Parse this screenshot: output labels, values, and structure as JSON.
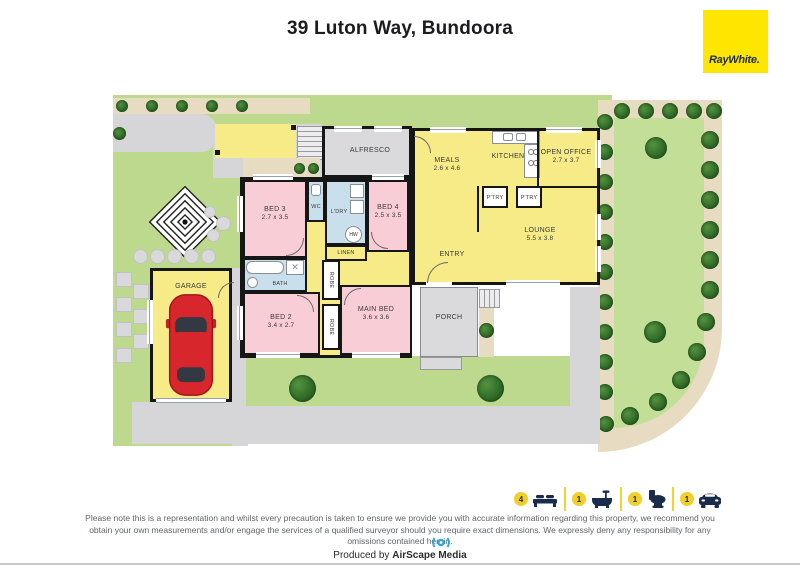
{
  "title": "39 Luton Way, Bundoora",
  "brand": {
    "logo_text": "RayWhite.",
    "bg_color": "#FFE600",
    "text_color": "#1D2B4F"
  },
  "floorplan": {
    "rooms": {
      "alfresco": {
        "name": "ALFRESCO"
      },
      "meals": {
        "name": "MEALS",
        "dims": "2.6 x 4.6"
      },
      "kitchen": {
        "name": "KITCHEN"
      },
      "open_office": {
        "name": "OPEN OFFICE",
        "dims": "2.7 x 3.7"
      },
      "pantry1": {
        "name": "P'TRY"
      },
      "pantry2": {
        "name": "P'TRY"
      },
      "lounge": {
        "name": "LOUNGE",
        "dims": "5.5 x 3.8"
      },
      "entry": {
        "name": "ENTRY"
      },
      "bed3": {
        "name": "BED 3",
        "dims": "2.7 x 3.5"
      },
      "bed4": {
        "name": "BED 4",
        "dims": "2.5 x 3.5"
      },
      "wc": {
        "name": "WC"
      },
      "laundry": {
        "name": "L'DRY"
      },
      "hot_water": {
        "name": "HW"
      },
      "linen": {
        "name": "LINEN"
      },
      "bath": {
        "name": "BATH"
      },
      "robe1": {
        "name": "ROBE"
      },
      "robe2": {
        "name": "ROBE"
      },
      "bed2": {
        "name": "BED 2",
        "dims": "3.4 x 2.7"
      },
      "main_bed": {
        "name": "MAIN BED",
        "dims": "3.6 x 3.6"
      },
      "porch": {
        "name": "PORCH"
      },
      "garage": {
        "name": "GARAGE"
      }
    }
  },
  "legend": {
    "items": [
      {
        "icon": "bed",
        "count": "4"
      },
      {
        "icon": "bath",
        "count": "1"
      },
      {
        "icon": "toilet",
        "count": "1"
      },
      {
        "icon": "car",
        "count": "1"
      }
    ]
  },
  "footer": {
    "disclaimer": "Please note this is a representation and whilst every precaution is taken to ensure we provide you with accurate information regarding this property, we recommend you obtain your own measurements and/or engage the services of a qualified surveyor should you require exact dimensions. We expressly deny any responsibility for any omissions contained herein.",
    "produced_by": "Produced by",
    "producer": "AirScape Media"
  },
  "colors": {
    "brand_yellow": "#FFE600",
    "navy": "#1B2B4C",
    "room_yellow": "#F6EB87",
    "room_pink": "#F9CDD6",
    "room_blue": "#C9E0EC",
    "room_gray": "#DADADC",
    "lawn_green": "#BCD98D",
    "path_tan": "#E7DBC2",
    "drive_gray": "#D6D6D8",
    "car_red": "#D8262D",
    "tree_green": "#316D28",
    "airscape_blue": "#2AA7DF"
  }
}
